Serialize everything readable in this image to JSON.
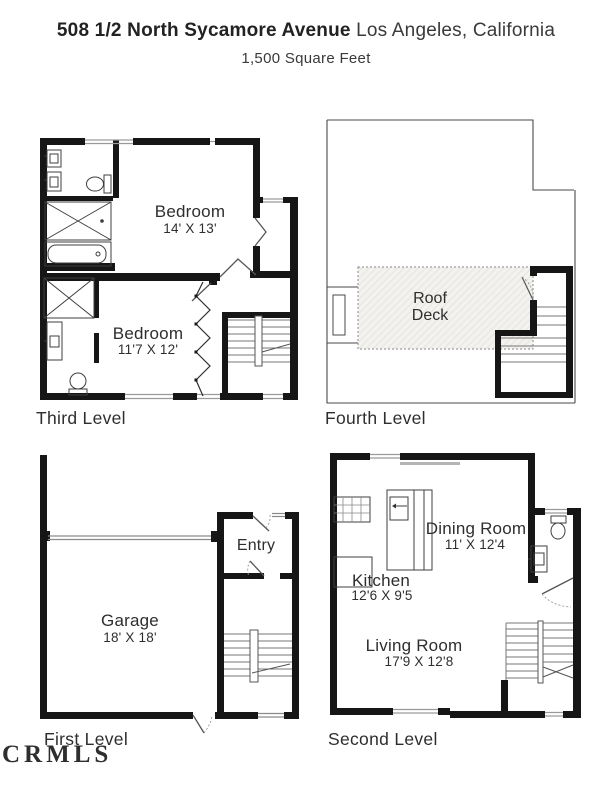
{
  "header": {
    "address": "508 1/2 North Sycamore Avenue",
    "city": "Los Angeles, California",
    "area": "1,500 Square Feet"
  },
  "levels": {
    "third": {
      "label": "Third Level"
    },
    "fourth": {
      "label": "Fourth Level"
    },
    "first": {
      "label": "First Level"
    },
    "second": {
      "label": "Second Level"
    }
  },
  "rooms": {
    "bedroom1": {
      "name": "Bedroom",
      "dims": "14' X 13'"
    },
    "bedroom2": {
      "name": "Bedroom",
      "dims": "11'7 X 12'"
    },
    "roof_deck": {
      "line1": "Roof",
      "line2": "Deck"
    },
    "entry": {
      "name": "Entry"
    },
    "garage": {
      "name": "Garage",
      "dims": "18' X 18'"
    },
    "dining": {
      "name": "Dining Room",
      "dims": "11' X 12'4"
    },
    "kitchen": {
      "name": "Kitchen",
      "dims": "12'6 X 9'5"
    },
    "living": {
      "name": "Living Room",
      "dims": "17'9 X 12'8"
    }
  },
  "watermark": "CRMLS",
  "colors": {
    "wall": "#161616",
    "window_line": "#9a9a9a",
    "deck_fill": "#f3f2ef",
    "text": "#2e2e2e"
  }
}
